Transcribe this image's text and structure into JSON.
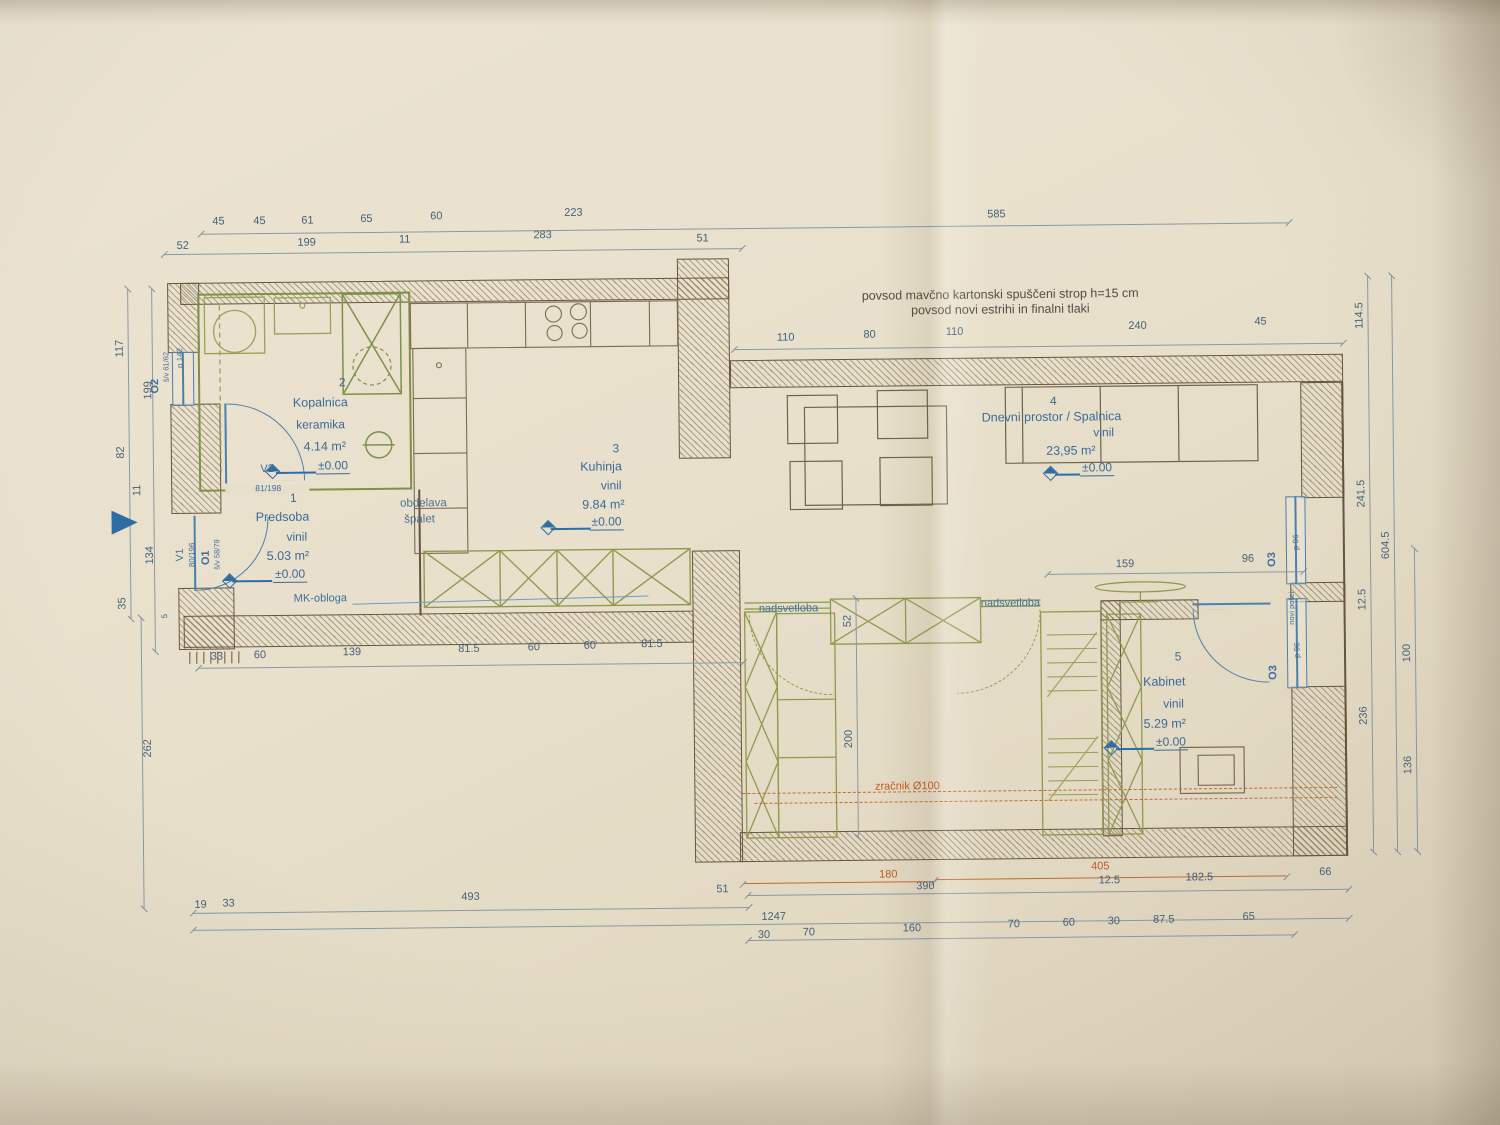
{
  "notes": {
    "ceiling1": "povsod mavčno kartonski spuščeni strop h=15 cm",
    "ceiling2": "povsod novi estrihi in finalni tlaki",
    "obdelava1": "obdelava",
    "obdelava2": "špalet",
    "mk": "MK-obloga",
    "nadsvetloba_l": "nadsvetloba",
    "nadsvetloba_r": "nadsvetloba",
    "zracnik": "zračnik Ø100"
  },
  "rooms": {
    "predsoba": {
      "num": "1",
      "name": "Predsoba",
      "floor": "vinil",
      "area": "5.03 m²",
      "level": "±0.00"
    },
    "kopalnica": {
      "num": "2",
      "name": "Kopalnica",
      "floor": "keramika",
      "area": "4.14 m²",
      "level": "±0.00"
    },
    "kuhinja": {
      "num": "3",
      "name": "Kuhinja",
      "floor": "vinil",
      "area": "9.84 m²",
      "level": "±0.00"
    },
    "dnevni": {
      "num": "4",
      "name": "Dnevni prostor / Spalnica",
      "floor": "vinil",
      "area": "23,95 m²",
      "level": "±0.00"
    },
    "kabinet": {
      "num": "5",
      "name": "Kabinet",
      "floor": "vinil",
      "area": "5.29 m²",
      "level": "±0.00"
    }
  },
  "openings": {
    "v1": {
      "id": "V1",
      "size": "80/196"
    },
    "o1": {
      "id": "O1",
      "size": "š/v 58/79"
    },
    "o2": {
      "id": "O2",
      "size": "š/v 61/62",
      "parapet": "p 142"
    },
    "v2": {
      "id": "V2",
      "size": "81/198"
    },
    "o3_upper": {
      "id": "O3",
      "parapet": "p 96"
    },
    "o3_lower": {
      "id": "O3",
      "parapet": "p 96"
    },
    "shelf_note": "novi polici"
  },
  "dims": {
    "top1": [
      "45",
      "45",
      "61",
      "65",
      "60",
      "223",
      "585"
    ],
    "top2": [
      "52",
      "199",
      "11",
      "283",
      "51"
    ],
    "living_top": [
      "110",
      "80",
      "110",
      "240",
      "45"
    ],
    "left": [
      "117",
      "199",
      "82",
      "11",
      "99",
      "134",
      "35",
      "5",
      "262"
    ],
    "right_inner": [
      "114.5",
      "241.5",
      "12.5",
      "236"
    ],
    "right_total": "604.5",
    "right_outer": [
      "100",
      "136"
    ],
    "mid": [
      "33",
      "60",
      "139",
      "81.5",
      "60",
      "60",
      "81.5"
    ],
    "living_inner": {
      "tv": "159",
      "side": "96",
      "transom": "52",
      "depth": "200"
    },
    "bottom1": [
      "19",
      "33",
      "493",
      "51"
    ],
    "bottom_total": "1247",
    "bottom_orange": [
      "180",
      "405"
    ],
    "bottom2": [
      "390",
      "12.5",
      "182.5",
      "66"
    ],
    "bottom3": [
      "30",
      "70",
      "160",
      "70",
      "60",
      "30",
      "87.5",
      "65"
    ]
  },
  "colors": {
    "paper": "#e8dfca",
    "wall_line": "#64553c",
    "dim_blue": "#44627c",
    "label_blue": "#3c6a99",
    "green": "#8f9a50",
    "orange": "#c2692f",
    "window_blue": "#4a80b0"
  }
}
